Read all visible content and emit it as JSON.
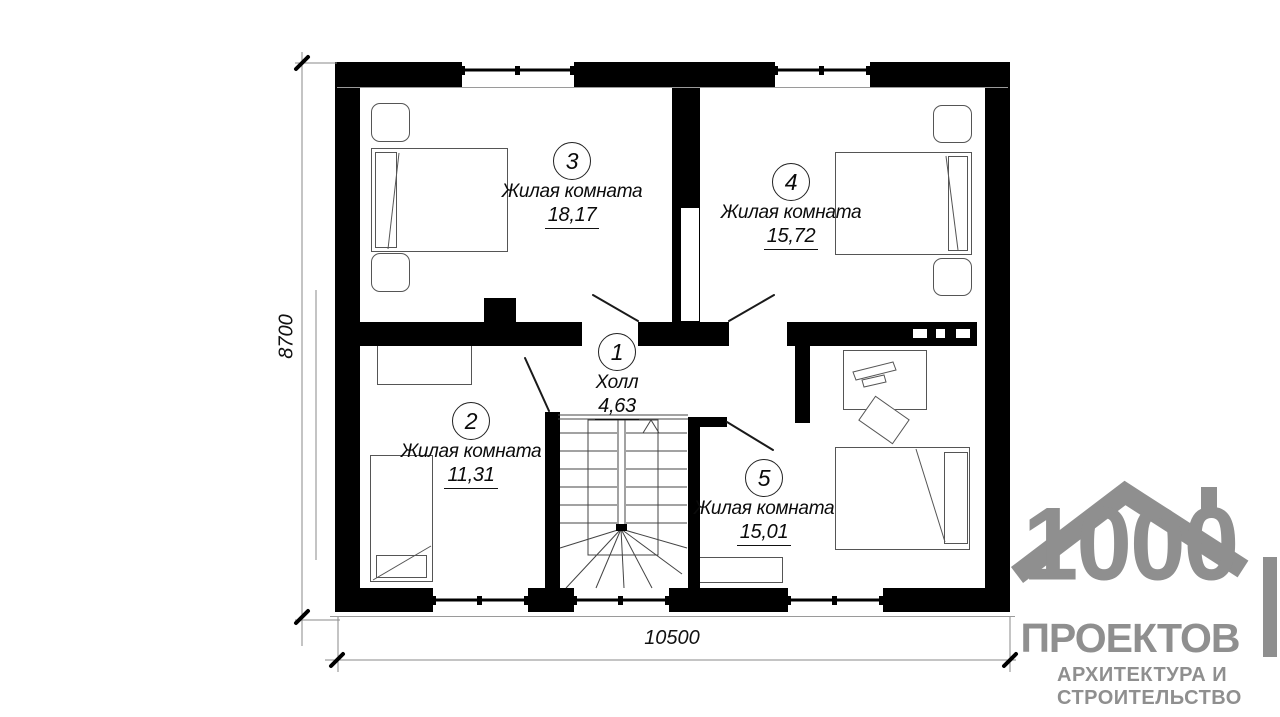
{
  "plan": {
    "rooms": [
      {
        "number": "3",
        "name": "Жилая комната",
        "area": "18,17"
      },
      {
        "number": "4",
        "name": "Жилая комната",
        "area": "15,72"
      },
      {
        "number": "1",
        "name": "Холл",
        "area": "4,63"
      },
      {
        "number": "2",
        "name": "Жилая комната",
        "area": "11,31"
      },
      {
        "number": "5",
        "name": "Жилая комната",
        "area": "15,01"
      }
    ],
    "dimensions": {
      "bottom": "10500",
      "left": "8700"
    }
  },
  "logo": {
    "number": "1000",
    "title": "ПРОЕКТОВ",
    "subtitle_line1": "АРХИТЕКТУРА И",
    "subtitle_line2": "СТРОИТЕЛЬСТВО"
  },
  "colors": {
    "wall": "#000000",
    "furniture_line": "#555555",
    "logo_gray": "#8f8f8f"
  }
}
